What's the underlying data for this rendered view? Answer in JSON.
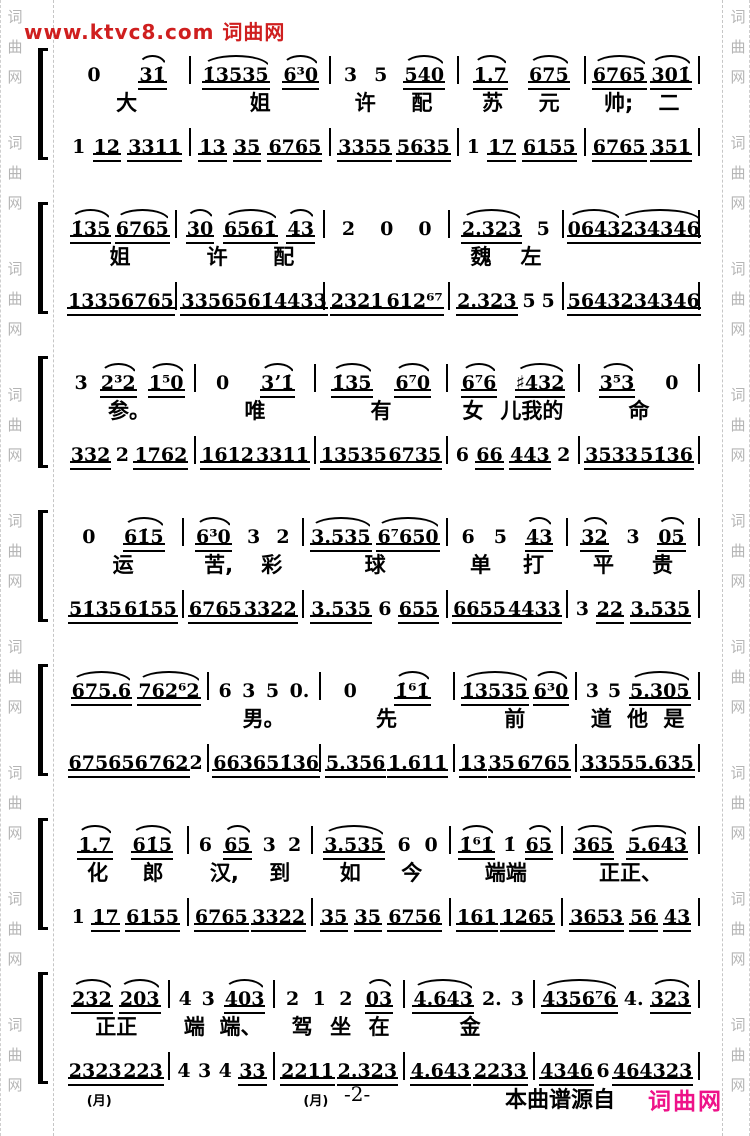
{
  "page": {
    "header": "www.ktvc8.com 词曲网",
    "watermark_chars": [
      "词",
      "曲",
      "网"
    ],
    "footer": {
      "page_number": "-2-",
      "source_text": "本曲谱源自",
      "source_site": "词曲网"
    },
    "colors": {
      "header_red": "#cf1f1f",
      "footer_pink": "#ee1289",
      "watermark_gray": "#b5b5b5",
      "ink": "#000000"
    }
  },
  "systems": [
    {
      "melody": [
        "0 31̇",
        "1̇3535 6³0",
        "3 5 540",
        "1.7 675",
        "6765 301̇"
      ],
      "lyrics": [
        "大",
        "姐",
        "许  配",
        "苏  元",
        "帅;  二"
      ],
      "accompaniment": [
        "1 12 3311",
        "13 35 6765",
        "3355 5635",
        "1 17 6155",
        "6765 351"
      ]
    },
    {
      "melody": [
        "1̇35 6765",
        "30 6561̇ 43",
        "2 0 0",
        "2.323 5",
        "0643 234346"
      ],
      "lyrics": [
        "姐",
        "许  配",
        "",
        "魏  左",
        ""
      ],
      "accompaniment": [
        "1335 6765",
        "3356561̇ 4433",
        "2321 612⁶⁷",
        "2.323 5 5",
        "5643 234346"
      ]
    },
    {
      "melody": [
        "3 2³2 1⁵0",
        "0 3ʼ1̇",
        "1̇35 6⁷0",
        "6⁷6 ♯432",
        "3⁵3 0"
      ],
      "lyrics": [
        "参。",
        "唯",
        "有",
        "女  儿我的",
        "命"
      ],
      "accompaniment": [
        "332 2 1762",
        "1612 3311",
        "13535 6735",
        "6 66 443 2",
        "3533 51̇36"
      ]
    },
    {
      "melody": [
        "0 61̇5",
        "6³0 3 2",
        "3.535 6⁷650",
        "6 5 43",
        "32 3 05"
      ],
      "lyrics": [
        "运",
        "苦,  彩",
        "球",
        "单  打",
        "平  贵"
      ],
      "accompaniment": [
        "51̇35 61̇55",
        "6765 3322",
        "3.535 6 655",
        "6655 4433",
        "3 22 3.535"
      ]
    },
    {
      "melody": [
        "675.6 762⁶2",
        "6 3 5 0.",
        "0 1̇⁶1̇",
        "1̇3535 6³0",
        "3 5 5.305"
      ],
      "lyrics": [
        "",
        "男。",
        "先",
        "前",
        "道  他  是"
      ],
      "accompaniment": [
        "675656 762 2",
        "6636 51̇36",
        "5.356 1.611",
        "13 35 6765",
        "3355 5.635"
      ]
    },
    {
      "melody": [
        "1.7 61̇5",
        "6 65 3 2",
        "3.535 6 0",
        "1̇⁶1̇ 1̇ 65",
        "365 5.643"
      ],
      "lyrics": [
        "化  郎",
        "汉,  到",
        "如  今",
        "端端",
        "正正、"
      ],
      "accompaniment": [
        "1 17 6155",
        "6765 3322",
        "35 35 6756",
        "161 1265",
        "3653 56 43"
      ]
    },
    {
      "melody": [
        "232 203",
        "4 3 403",
        "2 1 2 03",
        "4.643 2. 3",
        "4356⁷6 4. 323"
      ],
      "lyrics": [
        "正正",
        "端  端、",
        "驾  坐  在",
        "金",
        ""
      ],
      "accompaniment": [
        "2323 223",
        "4 3 4 33",
        "2211 2.323",
        "4.643 2233",
        "4346 6 464323"
      ],
      "accomp_labels": [
        "(月)",
        "",
        "(月)",
        "",
        ""
      ]
    }
  ]
}
